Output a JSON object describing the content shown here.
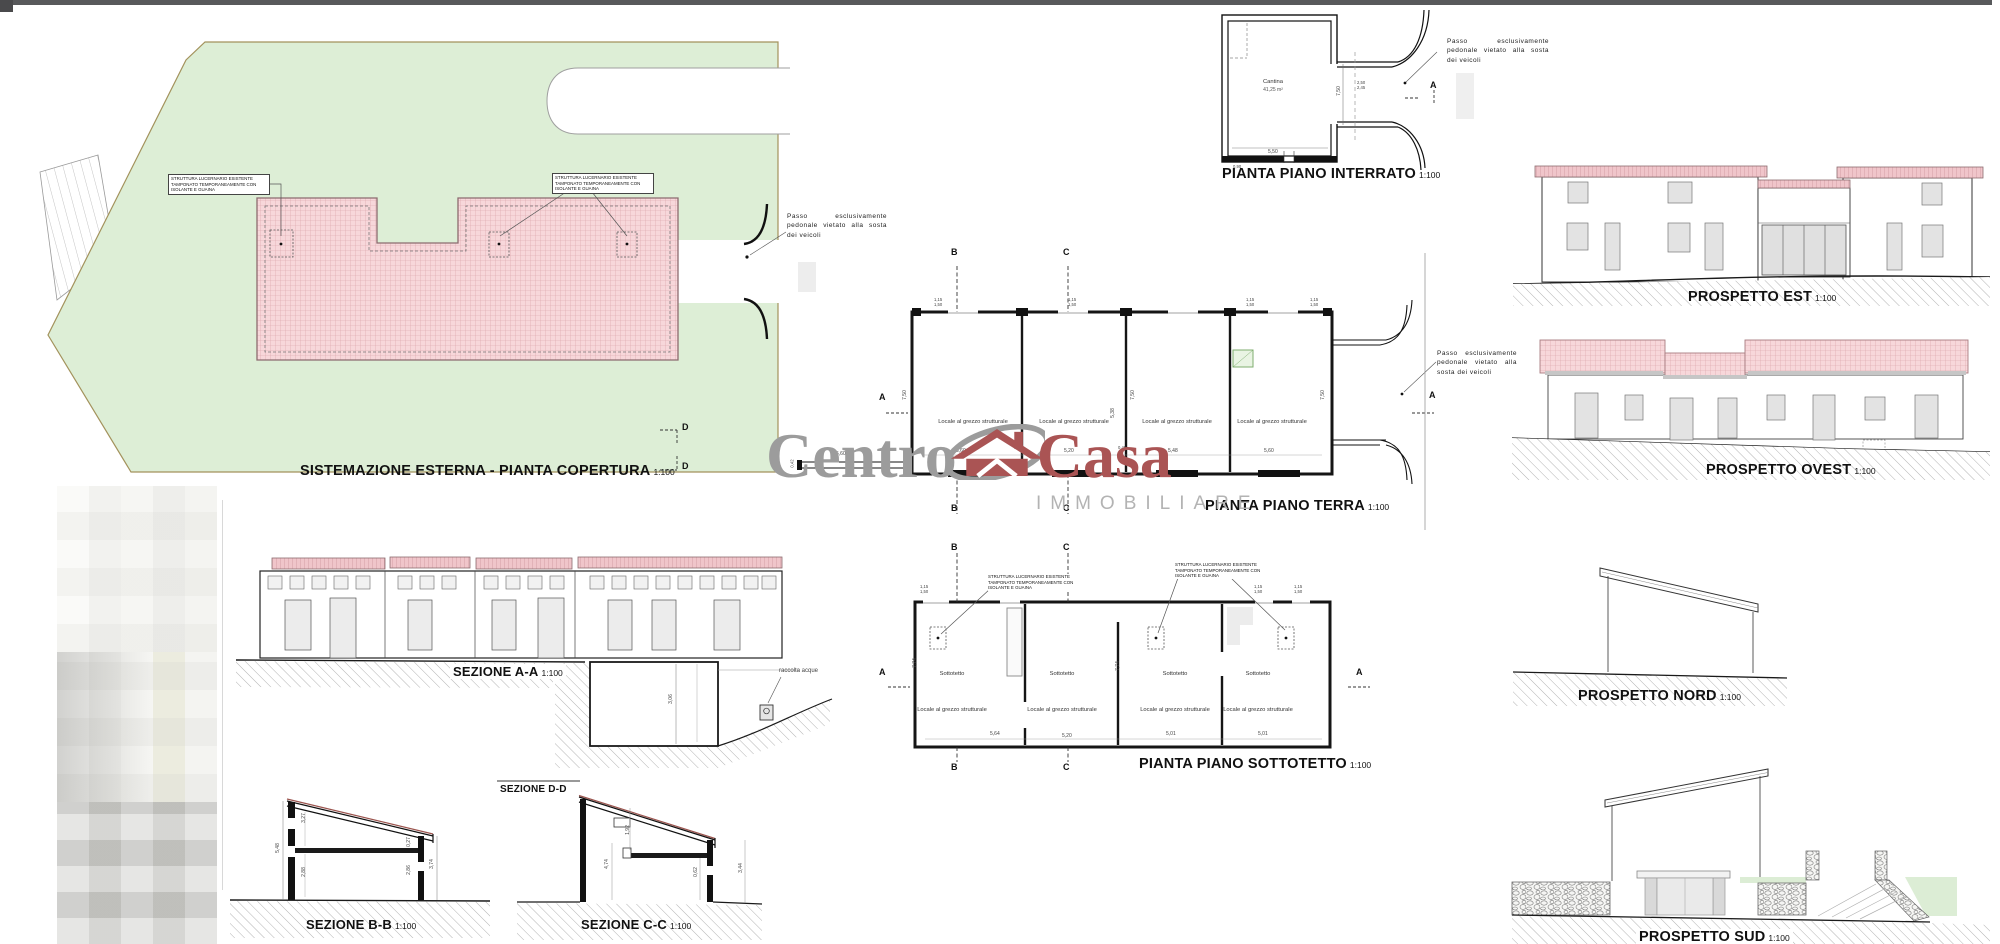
{
  "watermark": {
    "word1": "Centro",
    "word2": "Casa",
    "subtitle": "IMMOBILIARE"
  },
  "notes": {
    "passo": "Passo esclusivamente pedonale vietato alla sosta dei veicoli",
    "lucernario": "STRUTTURA LUCERNARIO ESISTENTE TAMPONATO TEMPORANEAMENTE CON ISOLANTE E GUAINA",
    "raccolta": "raccolta acque"
  },
  "markers": {
    "a": "A",
    "b": "B",
    "c": "C",
    "d": "D"
  },
  "panels": {
    "site": {
      "title": "SISTEMAZIONE ESTERNA - PIANTA COPERTURA",
      "scale": "1:100"
    },
    "interrato": {
      "title": "PIANTA PIANO INTERRATO",
      "scale": "1:100",
      "room": "Cantina",
      "area": "41,25 m²",
      "dims": {
        "h": "7,50",
        "w": "5,50",
        "d1": "2,50",
        "d2": "2,45",
        "door": "0,90"
      }
    },
    "terra": {
      "title": "PIANTA PIANO TERRA",
      "scale": "1:100",
      "room": "Locale al grezzo strutturale",
      "dims": {
        "r1": "5,60",
        "r2": "5,20",
        "r3": "5,48",
        "r4": "5,60",
        "wall": "0,45",
        "h1": "7,50",
        "h2": "7,50",
        "h3": "5,38",
        "h4": "7,50",
        "porch": "5,60",
        "porch_t": "0,42",
        "win_a": "1,15",
        "win_b": "1,50"
      }
    },
    "sottotetto": {
      "title": "PIANTA PIANO SOTTOTETTO",
      "scale": "1:100",
      "room": "Sottotetto",
      "sub": "Locale al grezzo strutturale",
      "dims": {
        "r1": "5,64",
        "r2": "5,20",
        "r3": "5,01",
        "r4": "5,01",
        "h1": "7,74",
        "h2": "7,74",
        "win_a": "1,15",
        "win_b": "1,50"
      }
    },
    "sez_a": {
      "title": "SEZIONE A-A",
      "scale": "1:100",
      "dim": "3,06"
    },
    "sez_b": {
      "title": "SEZIONE B-B",
      "scale": "1:100",
      "dims": {
        "left": "5,48",
        "i1": "3,27",
        "i2": "2,88",
        "i3": "0,27",
        "i4": "2,86",
        "right": "3,74"
      }
    },
    "sez_c": {
      "title": "SEZIONE C-C",
      "scale": "1:100",
      "dims": {
        "i1": "1,92",
        "left": "4,74",
        "i2": "0,62",
        "right": "3,44"
      }
    },
    "sez_d": {
      "title": "SEZIONE D-D"
    },
    "est": {
      "title": "PROSPETTO EST",
      "scale": "1:100"
    },
    "ovest": {
      "title": "PROSPETTO OVEST",
      "scale": "1:100"
    },
    "nord": {
      "title": "PROSPETTO NORD",
      "scale": "1:100"
    },
    "sud": {
      "title": "PROSPETTO SUD",
      "scale": "1:100"
    }
  },
  "colors": {
    "grass": "#ddeed6",
    "roof_fill": "#f7d7da",
    "roof_line": "#d8a0a6",
    "boundary": "#a3925c",
    "accent_red": "#aa5454",
    "accent_gray": "#9c9c9c"
  }
}
